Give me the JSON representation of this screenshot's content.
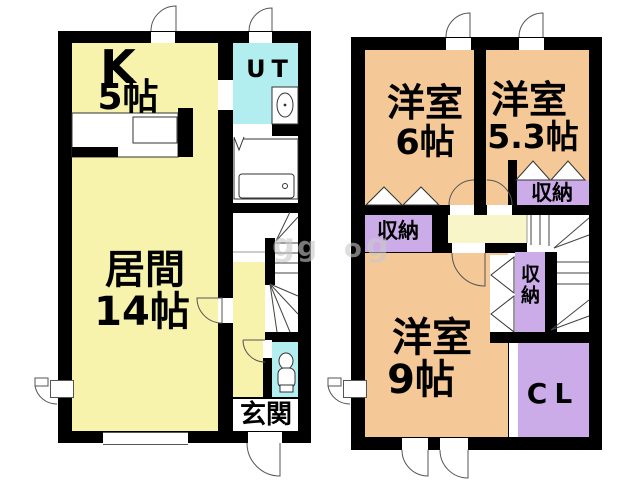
{
  "title": "floor-plan",
  "floor1": {
    "kitchen": {
      "label": "K",
      "size": "5帖"
    },
    "living": {
      "label": "居間",
      "size": "14帖"
    },
    "utility": {
      "label": "UT"
    },
    "entrance": {
      "label": "玄関"
    }
  },
  "floor2": {
    "bedroom6": {
      "label": "洋室",
      "size": "6帖"
    },
    "bedroom53": {
      "label": "洋室",
      "size": "5.3帖"
    },
    "bedroom9": {
      "label": "洋室",
      "size": "9帖"
    },
    "closet_a": {
      "label": "収納"
    },
    "closet_b": {
      "label": "収納"
    },
    "closet_c": {
      "label": "収納"
    },
    "cl": {
      "label": "CL"
    }
  },
  "watermark": {
    "g1": "g",
    "g2": "g",
    "g3": "o",
    "g4": "g"
  },
  "colors": {
    "wall": "#000000",
    "room_yellow": "#f7f2ac",
    "hall_yellow": "#f8f5c9",
    "room_orange": "#f5c897",
    "wet_cyan": "#b2edef",
    "closet_purple": "#ccabe9",
    "line_gray": "#555555"
  }
}
